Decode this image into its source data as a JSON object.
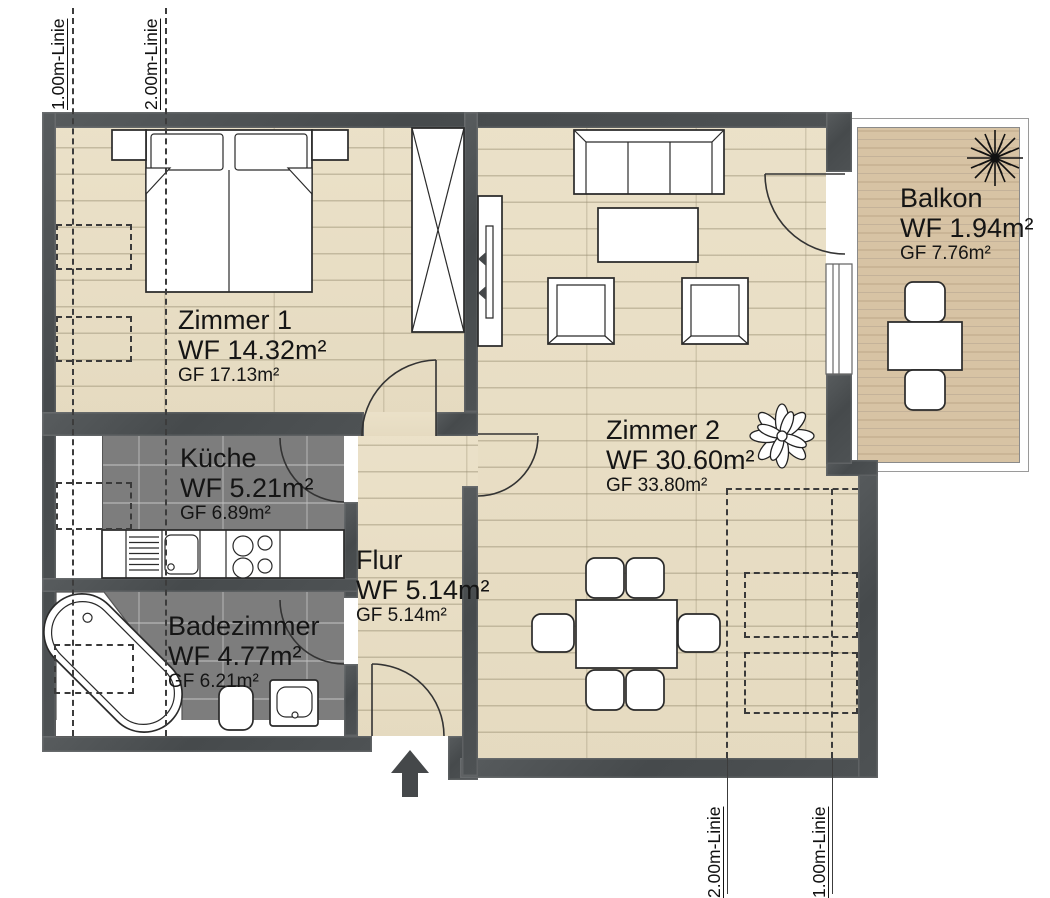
{
  "plan": {
    "rooms": [
      {
        "id": "zimmer1",
        "name": "Zimmer 1",
        "wf": "WF 14.32m²",
        "gf": "GF 17.13m²"
      },
      {
        "id": "kueche",
        "name": "Küche",
        "wf": "WF 5.21m²",
        "gf": "GF 6.89m²"
      },
      {
        "id": "badezimmer",
        "name": "Badezimmer",
        "wf": "WF 4.77m²",
        "gf": "GF 6.21m²"
      },
      {
        "id": "flur",
        "name": "Flur",
        "wf": "WF 5.14m²",
        "gf": "GF 5.14m²"
      },
      {
        "id": "zimmer2",
        "name": "Zimmer 2",
        "wf": "WF 30.60m²",
        "gf": "GF 33.80m²"
      },
      {
        "id": "balkon",
        "name": "Balkon",
        "wf": "WF 1.94m²",
        "gf": "GF 7.76m²"
      }
    ],
    "guides": {
      "top": [
        {
          "label": "1.00m-Linie"
        },
        {
          "label": "2.00m-Linie"
        }
      ],
      "bottom": [
        {
          "label": "2.00m-Linie"
        },
        {
          "label": "1.00m-Linie"
        }
      ]
    },
    "icons": [
      "double-bed",
      "nightstand",
      "wardrobe",
      "tv-sideboard",
      "sofa",
      "coffee-table",
      "armchair",
      "plant",
      "dining-table",
      "dining-chair",
      "kitchen-counter",
      "kitchen-sink",
      "cooktop",
      "bathtub",
      "toilet",
      "washbasin",
      "balcony-table",
      "balcony-chair",
      "entrance-arrow",
      "door-swing",
      "window"
    ],
    "colors": {
      "wall": "#4a4d4f",
      "wood_floor": "#e9dfc6",
      "tile_floor": "#7d7d7d",
      "balcony_deck": "#d7c3a4",
      "background": "#ffffff",
      "outline": "#2a2a2a",
      "dashed_guide": "#3c3c3c"
    }
  }
}
